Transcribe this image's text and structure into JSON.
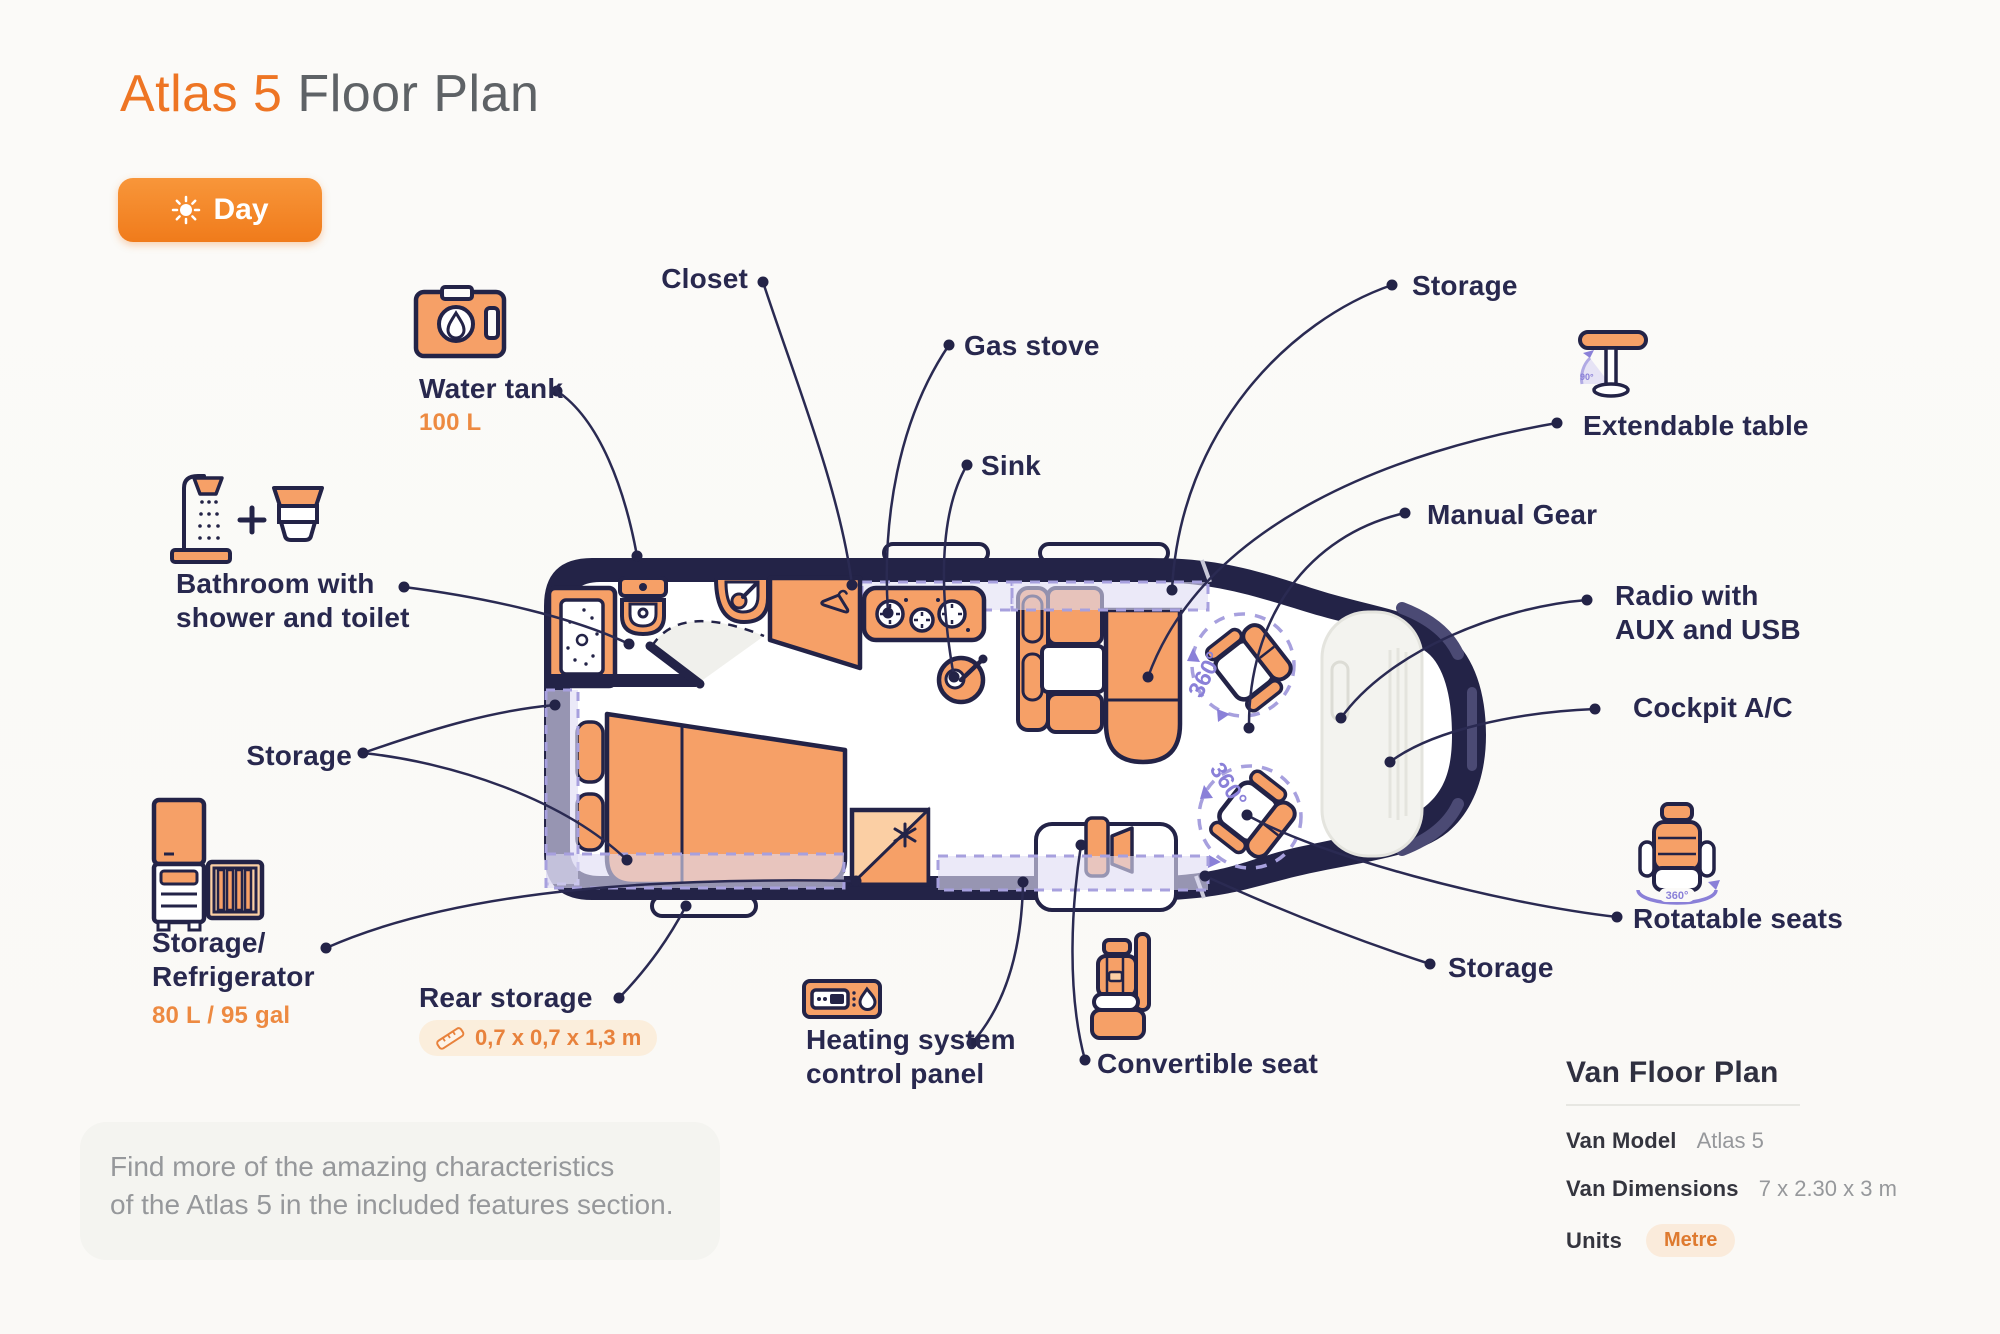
{
  "title": {
    "accent": "Atlas 5",
    "rest": " Floor Plan"
  },
  "day_toggle": {
    "label": "Day",
    "icon": "sun-icon"
  },
  "callouts": {
    "water_tank": {
      "label": "Water tank",
      "value": "100 L"
    },
    "bathroom": {
      "label": "Bathroom with\nshower and toilet"
    },
    "storage_left": {
      "label": "Storage"
    },
    "storage_refrigerator": {
      "label": "Storage/\nRefrigerator",
      "value": "80 L / 95 gal"
    },
    "rear_storage": {
      "label": "Rear storage",
      "dimensions": "0,7 x 0,7 x 1,3 m"
    },
    "closet": {
      "label": "Closet"
    },
    "gas_stove": {
      "label": "Gas stove"
    },
    "sink": {
      "label": "Sink"
    },
    "heating": {
      "label": "Heating system\ncontrol panel"
    },
    "convertible_seat": {
      "label": "Convertible seat"
    },
    "storage_top": {
      "label": "Storage"
    },
    "extendable_table": {
      "label": "Extendable table"
    },
    "manual_gear": {
      "label": "Manual Gear"
    },
    "radio": {
      "label": "Radio with\nAUX and USB"
    },
    "cockpit_ac": {
      "label": "Cockpit A/C"
    },
    "rotatable_seats": {
      "label": "Rotatable seats"
    },
    "storage_bottom": {
      "label": "Storage"
    }
  },
  "diagram": {
    "seat_rotation": "360°",
    "table_fold": "90°"
  },
  "note": {
    "text": "Find more of the amazing characteristics\nof the Atlas 5 in the included features section."
  },
  "info_panel": {
    "title": "Van Floor Plan",
    "rows": [
      {
        "label": "Van Model",
        "value": "Atlas 5"
      },
      {
        "label": "Van Dimensions",
        "value": "7 x 2.30 x 3 m"
      },
      {
        "label": "Units",
        "value": "Metre"
      }
    ]
  },
  "colors": {
    "accent_orange": "#EE7524",
    "furniture_orange": "#F6A067",
    "furniture_light": "#FBCFA4",
    "navy_outline": "#232347",
    "label_navy": "#28284E",
    "value_orange": "#ED8A41",
    "lavender_dash": "#A7A0DE",
    "purple_rotation": "#8A80D8",
    "pill_bg": "#FBEEDC",
    "note_bg": "#F4F4F0",
    "page_bg": "#FBFAF8"
  }
}
